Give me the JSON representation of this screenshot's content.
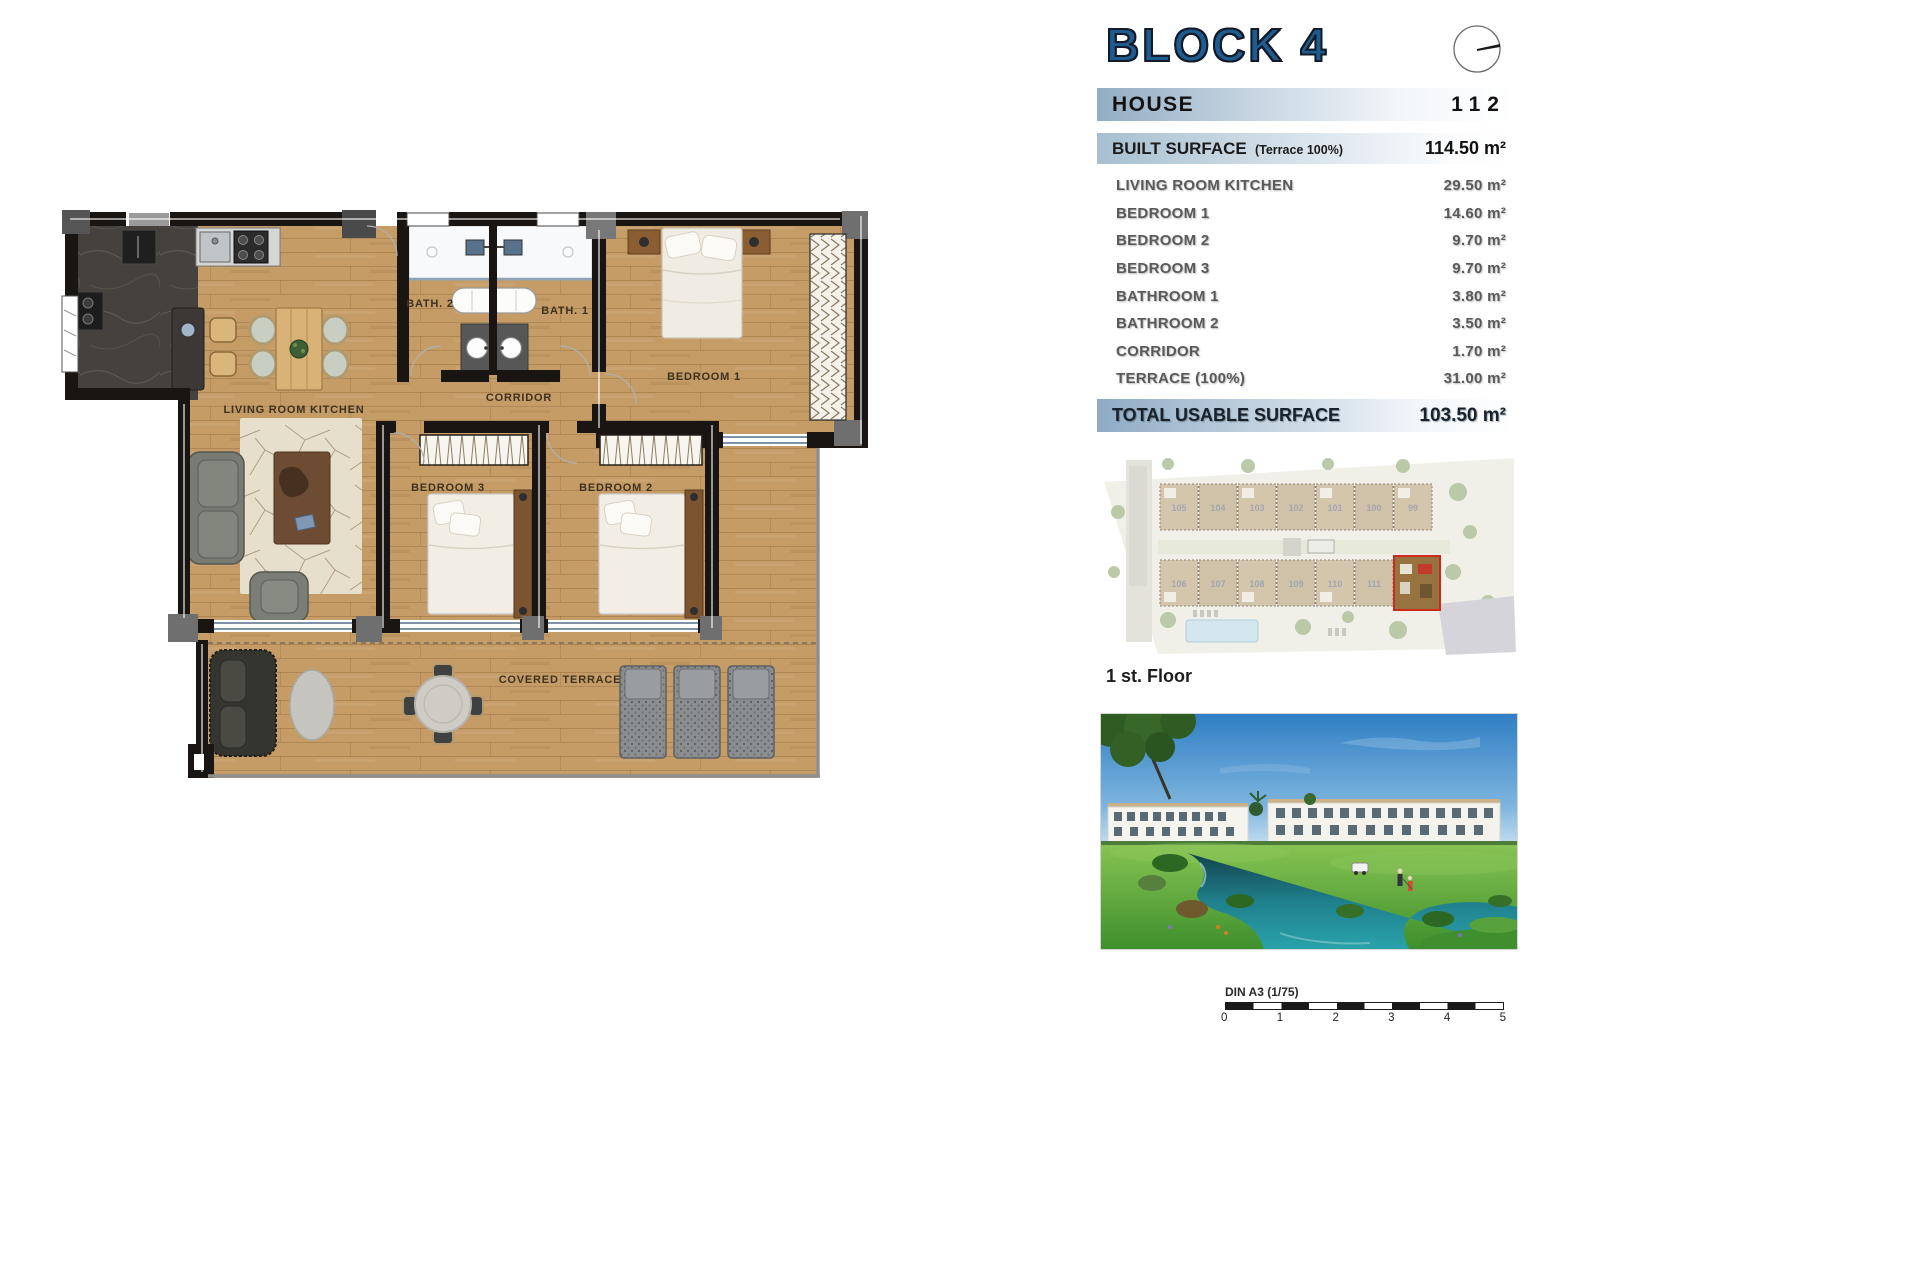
{
  "panel": {
    "block_title": "BLOCK 4",
    "house": {
      "label": "HOUSE",
      "number": "112"
    },
    "built": {
      "label": "BUILT SURFACE",
      "note": "(Terrace 100%)",
      "value": "114.50 m²"
    },
    "rows": [
      {
        "label": "LIVING ROOM KITCHEN",
        "value": "29.50 m²"
      },
      {
        "label": "BEDROOM 1",
        "value": "14.60 m²"
      },
      {
        "label": "BEDROOM 2",
        "value": "9.70 m²"
      },
      {
        "label": "BEDROOM 3",
        "value": "9.70 m²"
      },
      {
        "label": "BATHROOM 1",
        "value": "3.80 m²"
      },
      {
        "label": "BATHROOM 2",
        "value": "3.50 m²"
      },
      {
        "label": "CORRIDOR",
        "value": "1.70 m²"
      },
      {
        "label": "TERRACE (100%)",
        "value": "31.00 m²"
      }
    ],
    "total": {
      "label": "TOTAL USABLE SURFACE",
      "value": "103.50 m²"
    },
    "floor_caption": "1 st. Floor",
    "scale": {
      "label": "DIN A3 (1/75)",
      "ticks": [
        "0",
        "1",
        "2",
        "3",
        "4",
        "5"
      ]
    }
  },
  "plan": {
    "labels": {
      "living": "LIVING ROOM KITCHEN",
      "bath2": "BATH. 2",
      "bath1": "BATH. 1",
      "corridor": "CORRIDOR",
      "bedroom1": "BEDROOM 1",
      "bedroom2": "BEDROOM 2",
      "bedroom3": "BEDROOM 3",
      "terrace": "COVERED TERRACE"
    }
  },
  "siteplan": {
    "top_units": [
      "105",
      "104",
      "103",
      "102",
      "101",
      "100",
      "99"
    ],
    "bottom_units": [
      "106",
      "107",
      "108",
      "109",
      "110",
      "111"
    ]
  },
  "colors": {
    "accent_blue": "#1e5c90",
    "bar_steel": "#92adc2",
    "highlight_red": "#cc2a1c"
  }
}
